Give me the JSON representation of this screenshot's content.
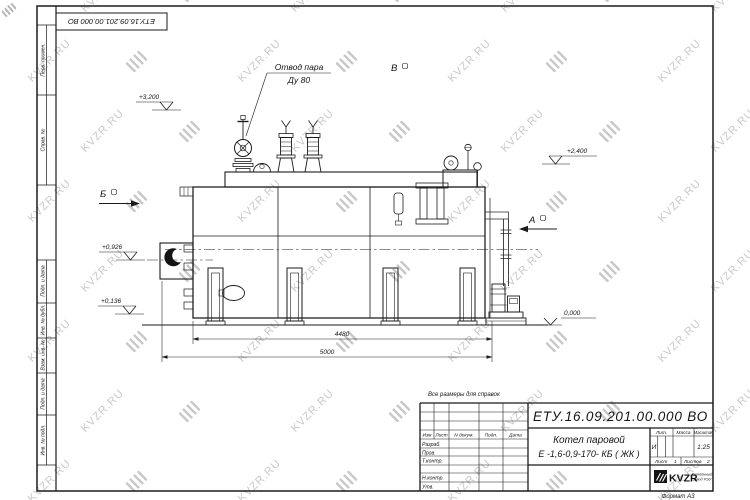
{
  "watermark": {
    "text": "KVZR.RU",
    "color": "#c9c9c9"
  },
  "frame": {
    "stamp_doc_number": "ЕТУ.16.09.201.00.000  ВО",
    "left_labels": {
      "perv_primen": "Перв. примен.",
      "sprav_no": "Справ. №",
      "podp_data_1": "Подп. и дата",
      "inv_dubl": "Инв. № дубл.",
      "vzam_inv": "Взам. инв. №",
      "podp_data_2": "Подп. и дата",
      "inv_podl": "Инв. № подл."
    }
  },
  "drawing": {
    "callout": {
      "line1": "Отвод пара",
      "line2": "Ду 80"
    },
    "elevations": [
      "+3,200",
      "+2,400",
      "+0,926",
      "+0,136",
      "0,000"
    ],
    "views": [
      "Б",
      "В",
      "А"
    ],
    "dimensions": [
      "4480",
      "5000"
    ]
  },
  "note_reference": "Все размеры для справок",
  "title_block": {
    "doc_number": "ЕТУ.16.09.201.00.000  ВО",
    "product_name_line1": "Котел паровой",
    "product_name_line2": "Е -1,6-0,9-170- КБ ( ЖК )",
    "header_cols": [
      "Изм",
      "Лист",
      "N докум.",
      "Подп.",
      "Дата"
    ],
    "rows": [
      "Разраб.",
      "Пров.",
      "Т.контр.",
      "Н.контр.",
      "Утв."
    ],
    "lit_label": "Лит.",
    "mass_label": "Масса",
    "scale_label": "Масштаб",
    "lit_value": "И",
    "scale_value": "1:25",
    "sheet_label": "Лист",
    "sheet_value": "1",
    "sheets_label": "Листов",
    "sheets_value": "2",
    "company": {
      "logo_text": "KVZR",
      "tagline_line1": "Котельный",
      "tagline_line2": "завод РЭУ"
    },
    "format_note": "Формат  А3"
  }
}
